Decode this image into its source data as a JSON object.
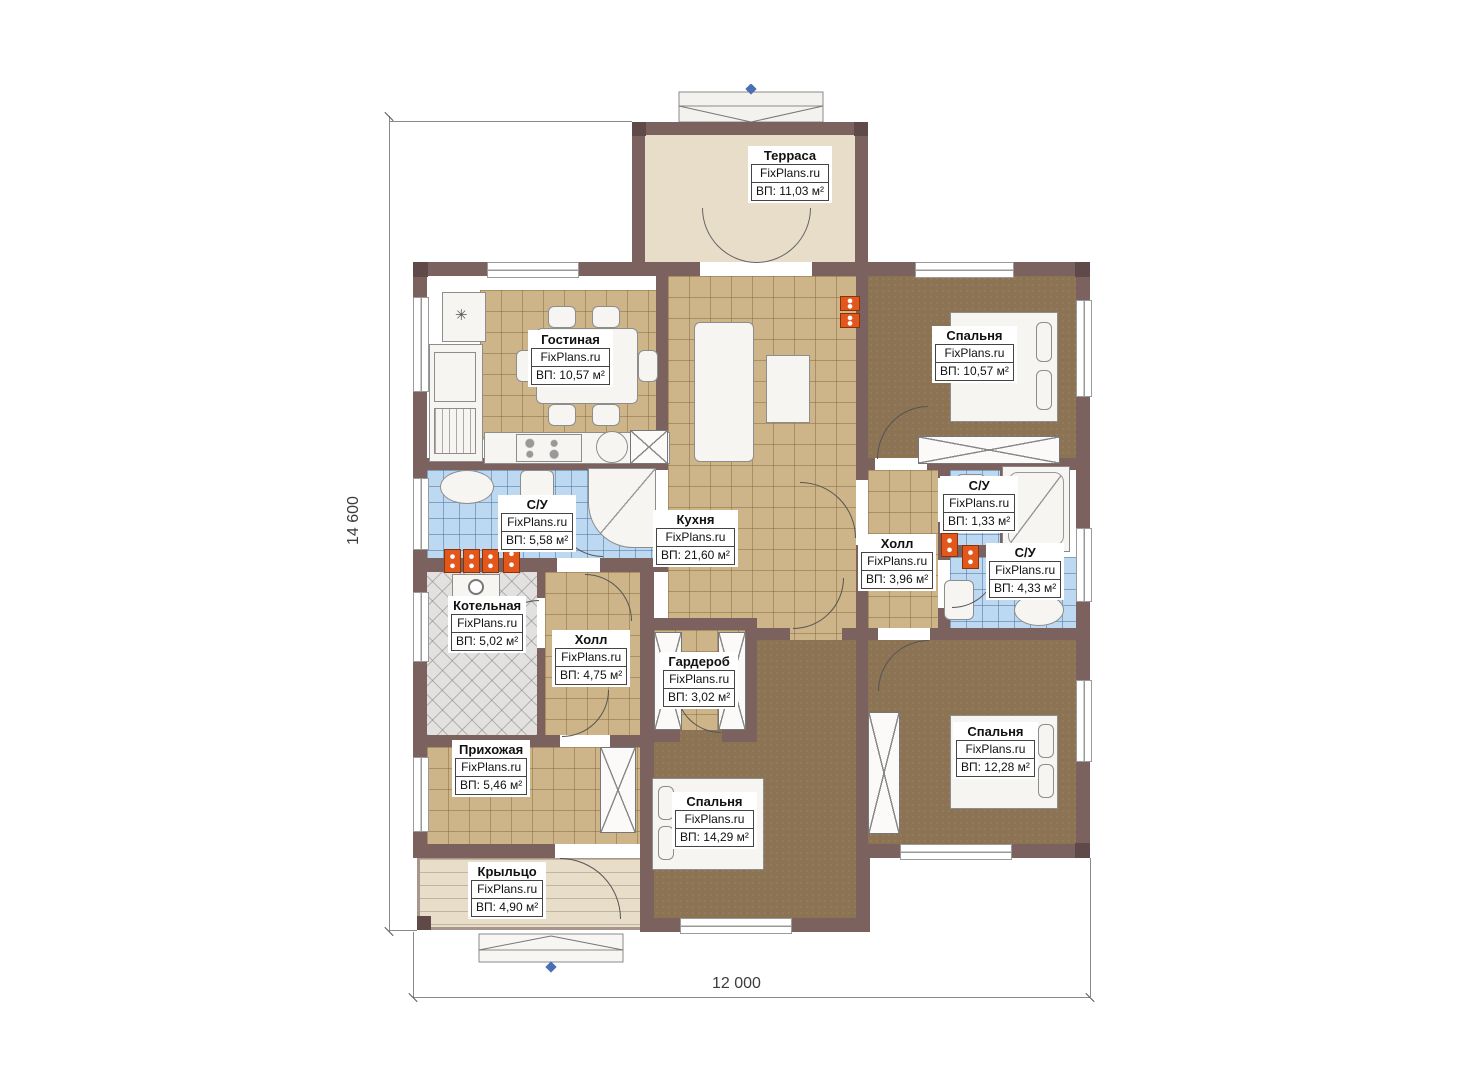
{
  "watermark": "FixPlans.ru",
  "dimensions": {
    "width_label": "12 000",
    "height_label": "14 600"
  },
  "rooms": {
    "terrace": {
      "name": "Терраса",
      "area": "ВП: 11,03 м²"
    },
    "living": {
      "name": "Гостиная",
      "area": "ВП: 10,57 м²"
    },
    "bedroom_top": {
      "name": "Спальня",
      "area": "ВП: 10,57 м²"
    },
    "bathroom_main": {
      "name": "С/У",
      "area": "ВП: 5,58 м²"
    },
    "kitchen": {
      "name": "Кухня",
      "area": "ВП: 21,60 м²"
    },
    "hall_right": {
      "name": "Холл",
      "area": "ВП: 3,96 м²"
    },
    "wc_small": {
      "name": "С/У",
      "area": "ВП: 1,33 м²"
    },
    "bathroom_right": {
      "name": "С/У",
      "area": "ВП: 4,33 м²"
    },
    "boiler": {
      "name": "Котельная",
      "area": "ВП: 5,02 м²"
    },
    "hall_center": {
      "name": "Холл",
      "area": "ВП: 4,75 м²"
    },
    "wardrobe": {
      "name": "Гардероб",
      "area": "ВП: 3,02 м²"
    },
    "entry": {
      "name": "Прихожая",
      "area": "ВП: 5,46 м²"
    },
    "bedroom_center": {
      "name": "Спальня",
      "area": "ВП: 14,29 м²"
    },
    "bedroom_right": {
      "name": "Спальня",
      "area": "ВП: 12,28 м²"
    },
    "porch": {
      "name": "Крыльцо",
      "area": "ВП: 4,90 м²"
    }
  },
  "icons": {
    "freezer": "✳"
  },
  "colors": {
    "wall": "#7b625f",
    "tile_tan": "#cdb489",
    "carpet": "#8b7354",
    "tile_blue": "#bdd9f1",
    "tile_gray": "#e2e1df",
    "deck": "#e8ddc9",
    "radiator": "#e2581c",
    "marker": "#4a6fb5"
  }
}
